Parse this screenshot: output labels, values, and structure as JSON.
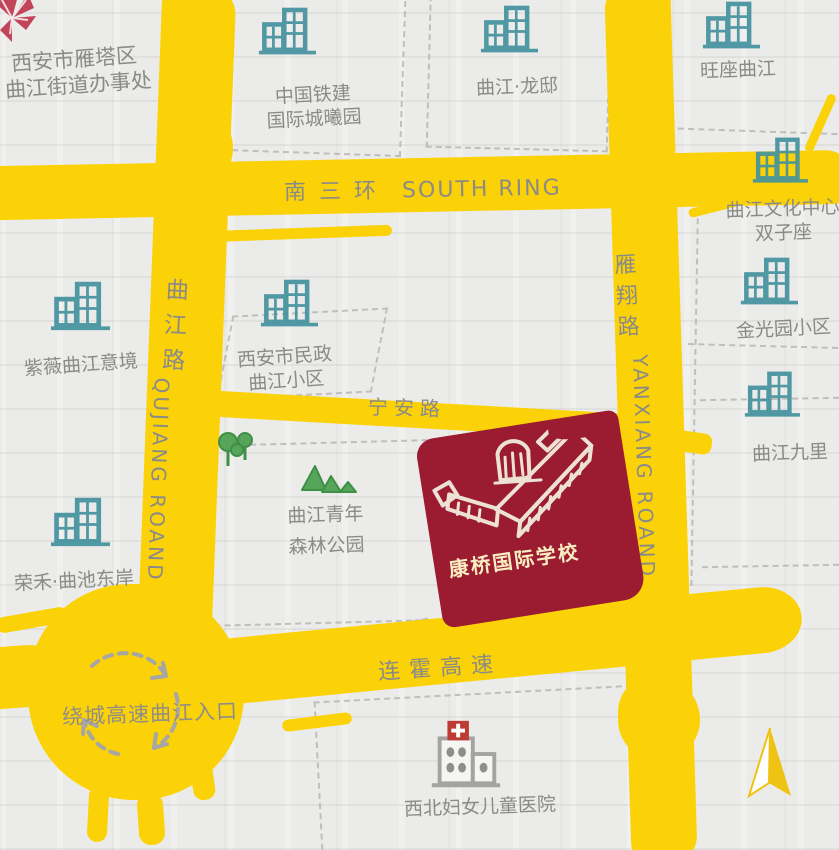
{
  "colors": {
    "yellow": "#FBD208",
    "red": "#9B1C31",
    "teal": "#43929E",
    "gray": "#8A8A88",
    "dash": "#AFAFAD",
    "green": "#54A458",
    "greenline": "#3F8F47",
    "hred": "#BE3B33",
    "gold": "#EFC313",
    "chalk": "#F2ECE0",
    "chalktext": "#F9EDC2"
  },
  "roads": {
    "south_ring": {
      "cn": "南三环",
      "en": "SOUTH RING"
    },
    "qujiang": {
      "chars": [
        "曲",
        "江",
        "路"
      ],
      "en": "QUJIANG ROAND"
    },
    "yanxiang": {
      "chars": [
        "雁",
        "翔",
        "路"
      ],
      "en": "YANXIANG ROAND"
    },
    "ningan": {
      "cn": "宁安路"
    },
    "lianhuo": {
      "cn": "连霍高速"
    },
    "ring_entrance": {
      "cn": "绕城高速曲江入口"
    }
  },
  "school": {
    "name": "康桥国际学校"
  },
  "places": {
    "street_office": {
      "line1": "西安市雁塔区",
      "line2": "曲江街道办事处"
    },
    "tiejian": {
      "line1": "中国铁建",
      "line2": "国际城曦园"
    },
    "longdi": {
      "line1": "曲江·龙邸"
    },
    "wangzuo": {
      "line1": "旺座曲江"
    },
    "wenhua": {
      "line1": "曲江文化中心",
      "line2": "双子座"
    },
    "jinguang": {
      "line1": "金光园小区"
    },
    "jiuli": {
      "line1": "曲江九里"
    },
    "ziwei": {
      "line1": "紫薇曲江意境"
    },
    "minzheng": {
      "line1": "西安市民政",
      "line2": "曲江小区"
    },
    "forest_park": {
      "line1": "曲江青年",
      "line2": "森林公园"
    },
    "ronghe": {
      "line1": "荣禾·曲池东岸"
    },
    "hospital": {
      "line1": "西北妇女儿童医院"
    }
  }
}
